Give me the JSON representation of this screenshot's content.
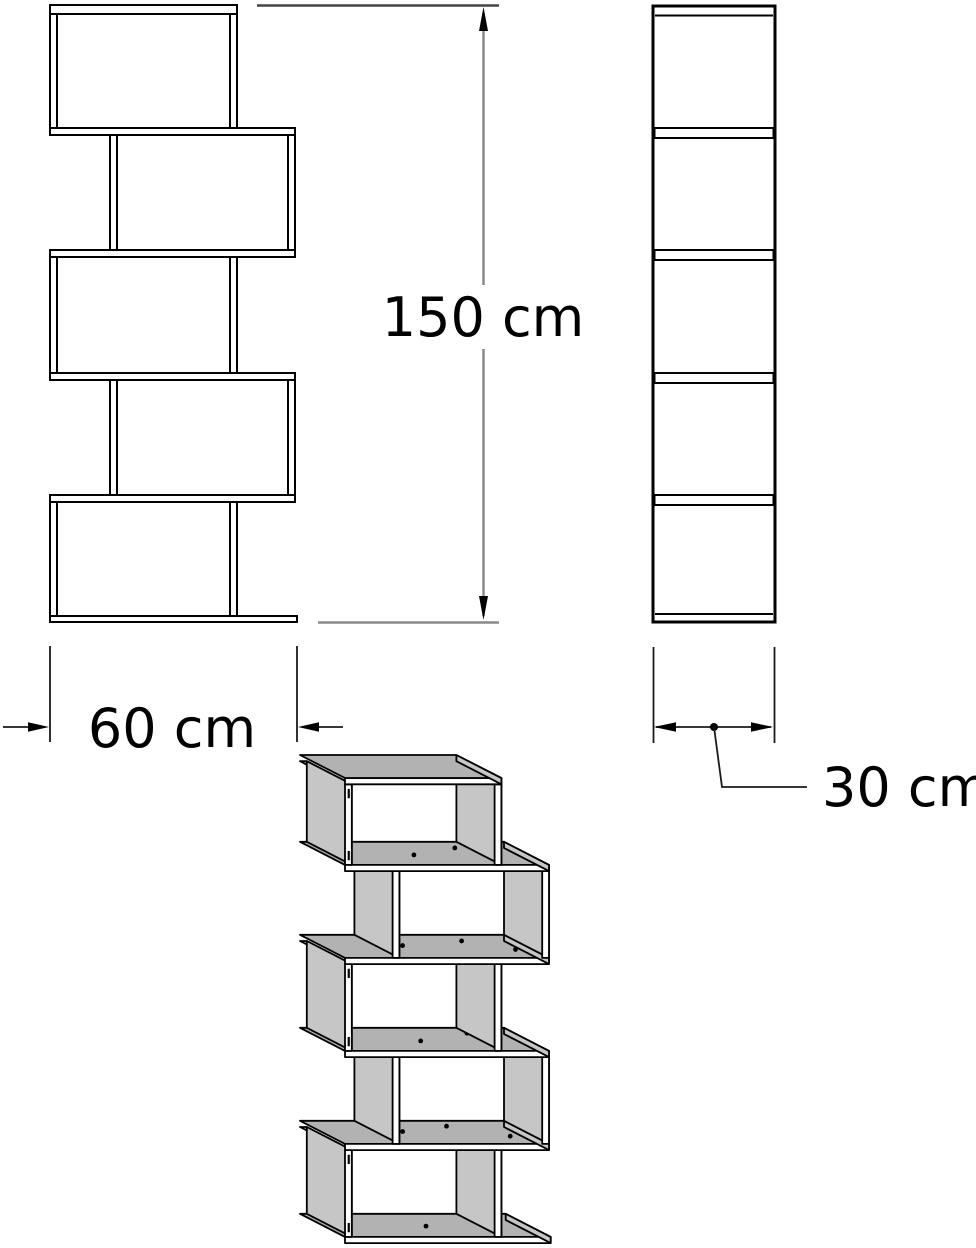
{
  "dimensions": {
    "height_label": "150 cm",
    "width_label": "60 cm",
    "depth_label": "30 cm",
    "height_value_cm": 150,
    "width_value_cm": 60,
    "depth_value_cm": 30
  },
  "shelf": {
    "compartments": 5,
    "description": "zigzag shelf drawing with front view, side view and perspective view"
  },
  "colors": {
    "outline": "#000000",
    "dimension_line_gray": "#8a8a8a",
    "extension_line_dark": "#444444",
    "thin_black": "#1a1a1a",
    "face_top": "#b2b2b2",
    "face_side": "#c6c6c6",
    "face_front": "#ffffff",
    "background": "#ffffff"
  }
}
